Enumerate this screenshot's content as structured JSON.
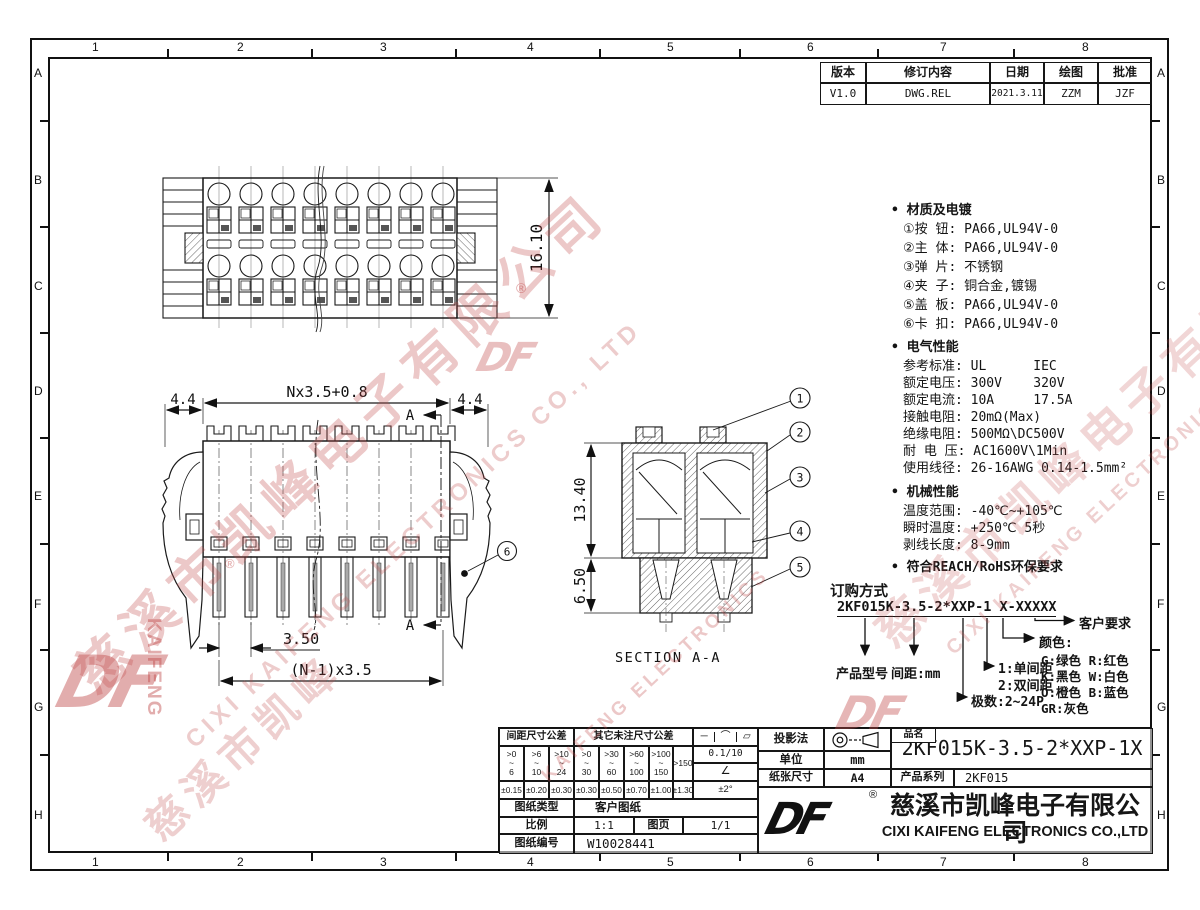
{
  "frame": {
    "cols": [
      "1",
      "2",
      "3",
      "4",
      "5",
      "6",
      "7",
      "8"
    ],
    "rows": [
      "A",
      "B",
      "C",
      "D",
      "E",
      "F",
      "G",
      "H"
    ]
  },
  "revision": {
    "headers": [
      "版本",
      "修订内容",
      "日期",
      "绘图",
      "批准"
    ],
    "row": [
      "V1.0",
      "DWG.REL",
      "2021.3.11",
      "ZZM",
      "JZF"
    ]
  },
  "specs": {
    "material_title": "• 材质及电镀",
    "material": [
      "①按 钮: PA66,UL94V-0",
      "②主 体: PA66,UL94V-0",
      "③弹 片: 不锈钢",
      "④夹 子: 铜合金,镀锡",
      "⑤盖 板: PA66,UL94V-0",
      "⑥卡 扣: PA66,UL94V-0"
    ],
    "electrical_title": "• 电气性能",
    "electrical": [
      "参考标准: UL      IEC",
      "额定电压: 300V    320V",
      "额定电流: 10A     17.5A",
      "接触电阻: 20mΩ(Max)",
      "绝缘电阻: 500MΩ\\DC500V",
      "耐 电 压: AC1600V\\1Min",
      "使用线径: 26-16AWG 0.14-1.5mm²"
    ],
    "mechanical_title": "• 机械性能",
    "mechanical": [
      "温度范围: -40℃~+105℃",
      "瞬时温度: +250℃ 5秒",
      "剥线长度: 8-9mm"
    ],
    "compliance": "• 符合REACH/RoHS环保要求"
  },
  "ordering": {
    "title": "订购方式",
    "code": "2KF015K-3.5-2*XXP-1 X-XXXXX",
    "model_label": "产品型号",
    "pitch_label": "间距:mm",
    "poles_label": "极数:2~24P",
    "row_single": "1:单间距",
    "row_double": "2:双间距",
    "color_label": "颜色:",
    "colors": [
      "G:绿色  R:红色",
      "K:黑色  W:白色",
      "O:橙色  B:蓝色",
      "GR:灰色"
    ],
    "customer_label": "客户要求"
  },
  "drawing": {
    "dim_width": "Nx3.5+0.8",
    "dim_left": "4.4",
    "dim_right": "4.4",
    "dim_height": "16.10",
    "dim_pitch": "3.50",
    "dim_span": "(N-1)x3.5",
    "dim_sec_upper": "13.40",
    "dim_sec_lower": "6.50",
    "section_title": "SECTION A-A",
    "marker": "A",
    "callouts": [
      "1",
      "2",
      "3",
      "4",
      "5",
      "6"
    ]
  },
  "title_block": {
    "tol_pitch_title": "间距尺寸公差",
    "tol_other_title": "其它未注尺寸公差",
    "syms": [
      "─",
      "⌒",
      "▱"
    ],
    "ranges": [
      ">0\n~\n6",
      ">6\n~\n10",
      ">10\n~\n24",
      ">0\n~\n30",
      ">30\n~\n60",
      ">60\n~\n100",
      ">100\n~\n150"
    ],
    "range_last": ">150",
    "values": [
      "±0.15",
      "±0.20",
      "±0.30",
      "±0.30",
      "±0.50",
      "±0.70",
      "±1.00",
      "±1.30"
    ],
    "flatness": "0.1/10",
    "angle_sym": "∠",
    "angle_tol": "±2°",
    "type_label": "图纸类型",
    "type_value": "客户图纸",
    "scale_label": "比例",
    "scale_value": "1:1",
    "page_label": "图页",
    "page_value": "1/1",
    "no_label": "图纸编号",
    "no_value": "W10028441",
    "projection_label": "投影法",
    "unit_label": "单位",
    "unit_value": "mm",
    "paper_label": "纸张尺寸",
    "paper_value": "A4",
    "name_label": "品名",
    "name_value": "2KF015K-3.5-2*XXP-1X",
    "series_label": "产品系列",
    "series_value": "2KF015",
    "company_cn": "慈溪市凯峰电子有限公司",
    "company_en": "CIXI KAIFENG ELECTRONICS CO.,LTD",
    "logo": "DF",
    "reg": "®"
  },
  "watermark": {
    "cn": "慈溪市凯峰电子有限公司",
    "cn_short": "慈溪市凯峰",
    "en": "CIXI KAIFENG ELECTRONICS CO., LTD",
    "en_short": "KAIFENG ELECTRONICS",
    "logo": "DF",
    "kaifeng": "KAIFENG",
    "reg": "®"
  },
  "colors": {
    "line": "#1a1a1a",
    "watermark": "#c14b4b"
  }
}
